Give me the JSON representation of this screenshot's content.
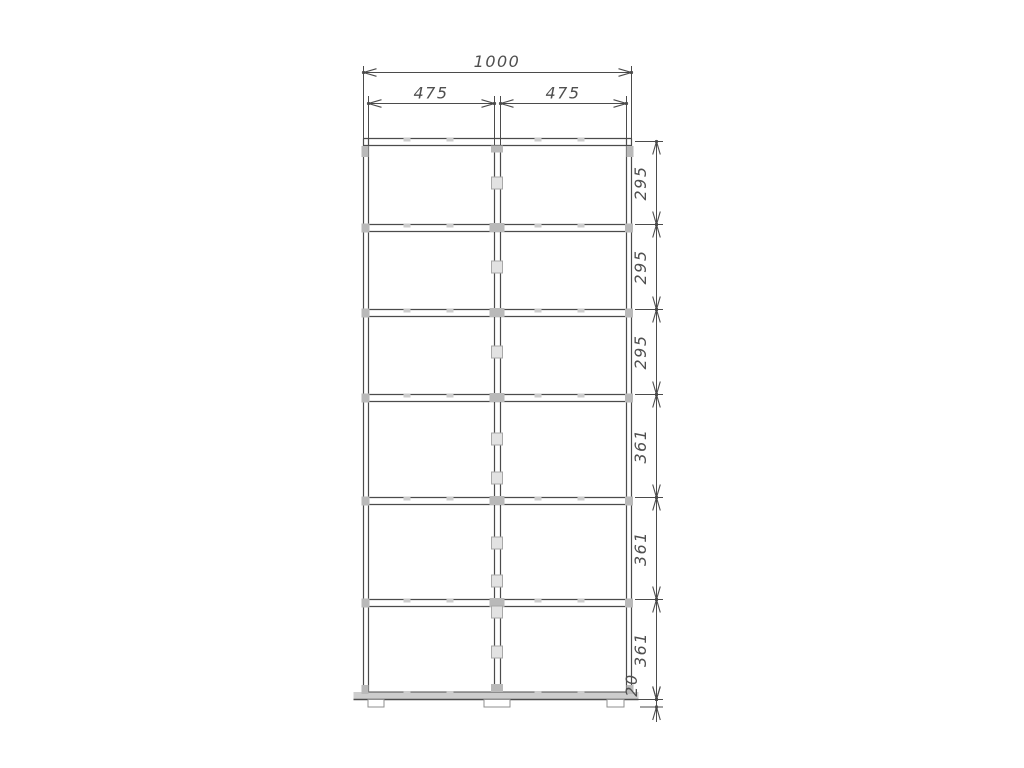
{
  "drawing": {
    "dimensions": {
      "total_width": "1000",
      "column_widths": [
        "475",
        "475"
      ],
      "row_heights": [
        "295",
        "295",
        "295",
        "361",
        "361",
        "361"
      ],
      "base_height": "20"
    },
    "colors": {
      "line": "#4b4b4b",
      "dim_text": "#4f4f4f",
      "connector": "#b9b9b9",
      "connector_light": "#cccccc",
      "bottom_panel_fill": "#cdcdcd",
      "foot_stroke": "#8f8f8f",
      "background": "#ffffff"
    },
    "structure": {
      "columns": 2,
      "rows": 6,
      "feet": 3
    }
  }
}
